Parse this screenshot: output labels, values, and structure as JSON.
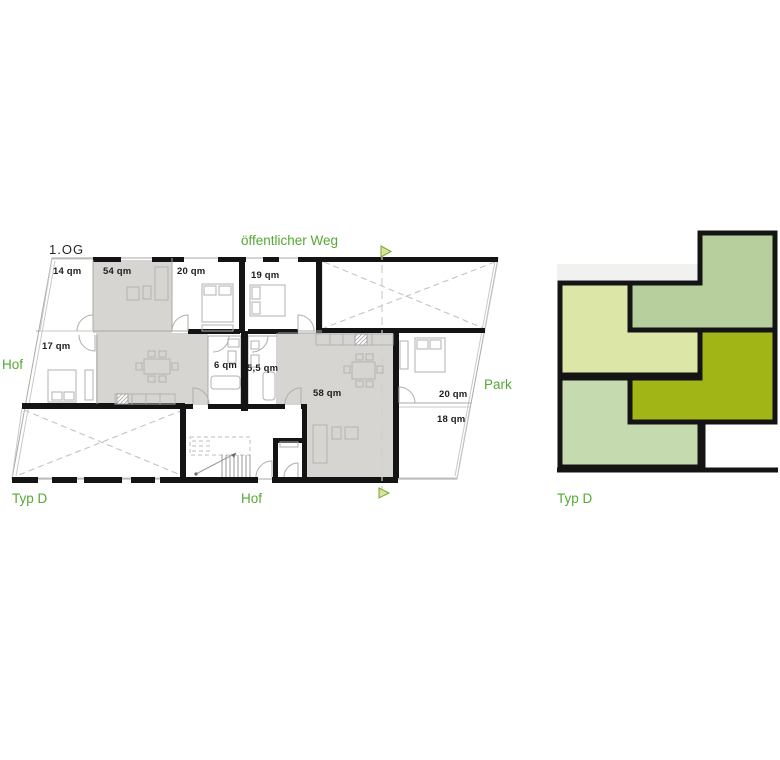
{
  "colors": {
    "green_label": "#56a834",
    "unit_fill": "#d6d5d1",
    "wall_black": "#141414",
    "thin_line": "#a9a9a7",
    "terrace_fill": "#f6f6f4",
    "scheme_pale": "#dce6a6",
    "scheme_sage": "#b7cf9d",
    "scheme_olive": "#a2b517",
    "scheme_light": "#c5dbaf",
    "scheme_strip": "#f1f1ef",
    "marker_fill": "#d9e49a",
    "marker_stroke": "#76a832"
  },
  "floor_plan": {
    "floor_label": "1.OG",
    "site_labels": {
      "top": "öffentlicher Weg",
      "left": "Hof",
      "right": "Park",
      "bottom_left": "Typ D",
      "bottom_center": "Hof"
    },
    "rooms": [
      {
        "id": "terrace-northwest",
        "area": "14 qm"
      },
      {
        "id": "unit-a-living",
        "area": "54 qm"
      },
      {
        "id": "unit-a-bedroom-north",
        "area": "20 qm"
      },
      {
        "id": "unit-b-bedroom-north",
        "area": "19 qm"
      },
      {
        "id": "unit-a-bedroom-west",
        "area": "17 qm"
      },
      {
        "id": "unit-a-bath",
        "area": "6 qm"
      },
      {
        "id": "unit-b-bath",
        "area": "5,5 qm"
      },
      {
        "id": "unit-b-living",
        "area": "58 qm"
      },
      {
        "id": "unit-b-bedroom-east",
        "area": "20 qm"
      },
      {
        "id": "terrace-southeast",
        "area": "18 qm"
      }
    ]
  },
  "scheme": {
    "caption": "Typ D",
    "units": [
      {
        "id": "scheme-unit-pale"
      },
      {
        "id": "scheme-unit-sage"
      },
      {
        "id": "scheme-unit-olive"
      },
      {
        "id": "scheme-unit-light"
      }
    ]
  }
}
